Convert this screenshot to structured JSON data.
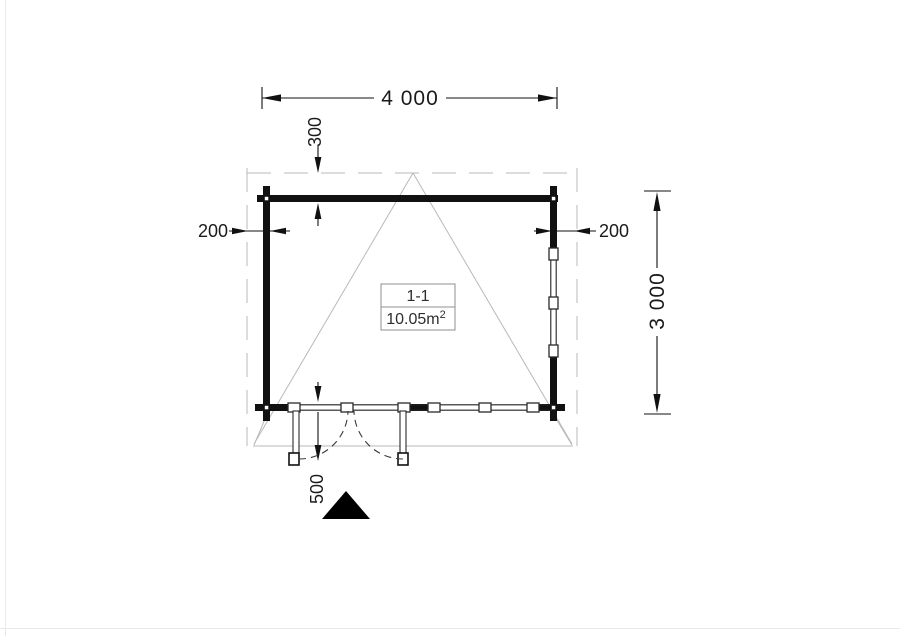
{
  "plan": {
    "title": "floor-plan-log-cabin",
    "room_label": {
      "name": "1-1",
      "area": "10.05m",
      "area_superscript": "2"
    },
    "dimensions": {
      "overall_width": "4 000",
      "overall_depth": "3 000",
      "overhang_top": "300",
      "overhang_left": "200",
      "overhang_right": "200",
      "terrace_depth": "500"
    },
    "colors": {
      "walls": "#111111",
      "dimension_lines": "#111111",
      "roof_outline_gray": "#b9b9b9",
      "door_swing": "#3a3a3a",
      "entrance_marker": "#000000",
      "background": "#ffffff"
    }
  }
}
